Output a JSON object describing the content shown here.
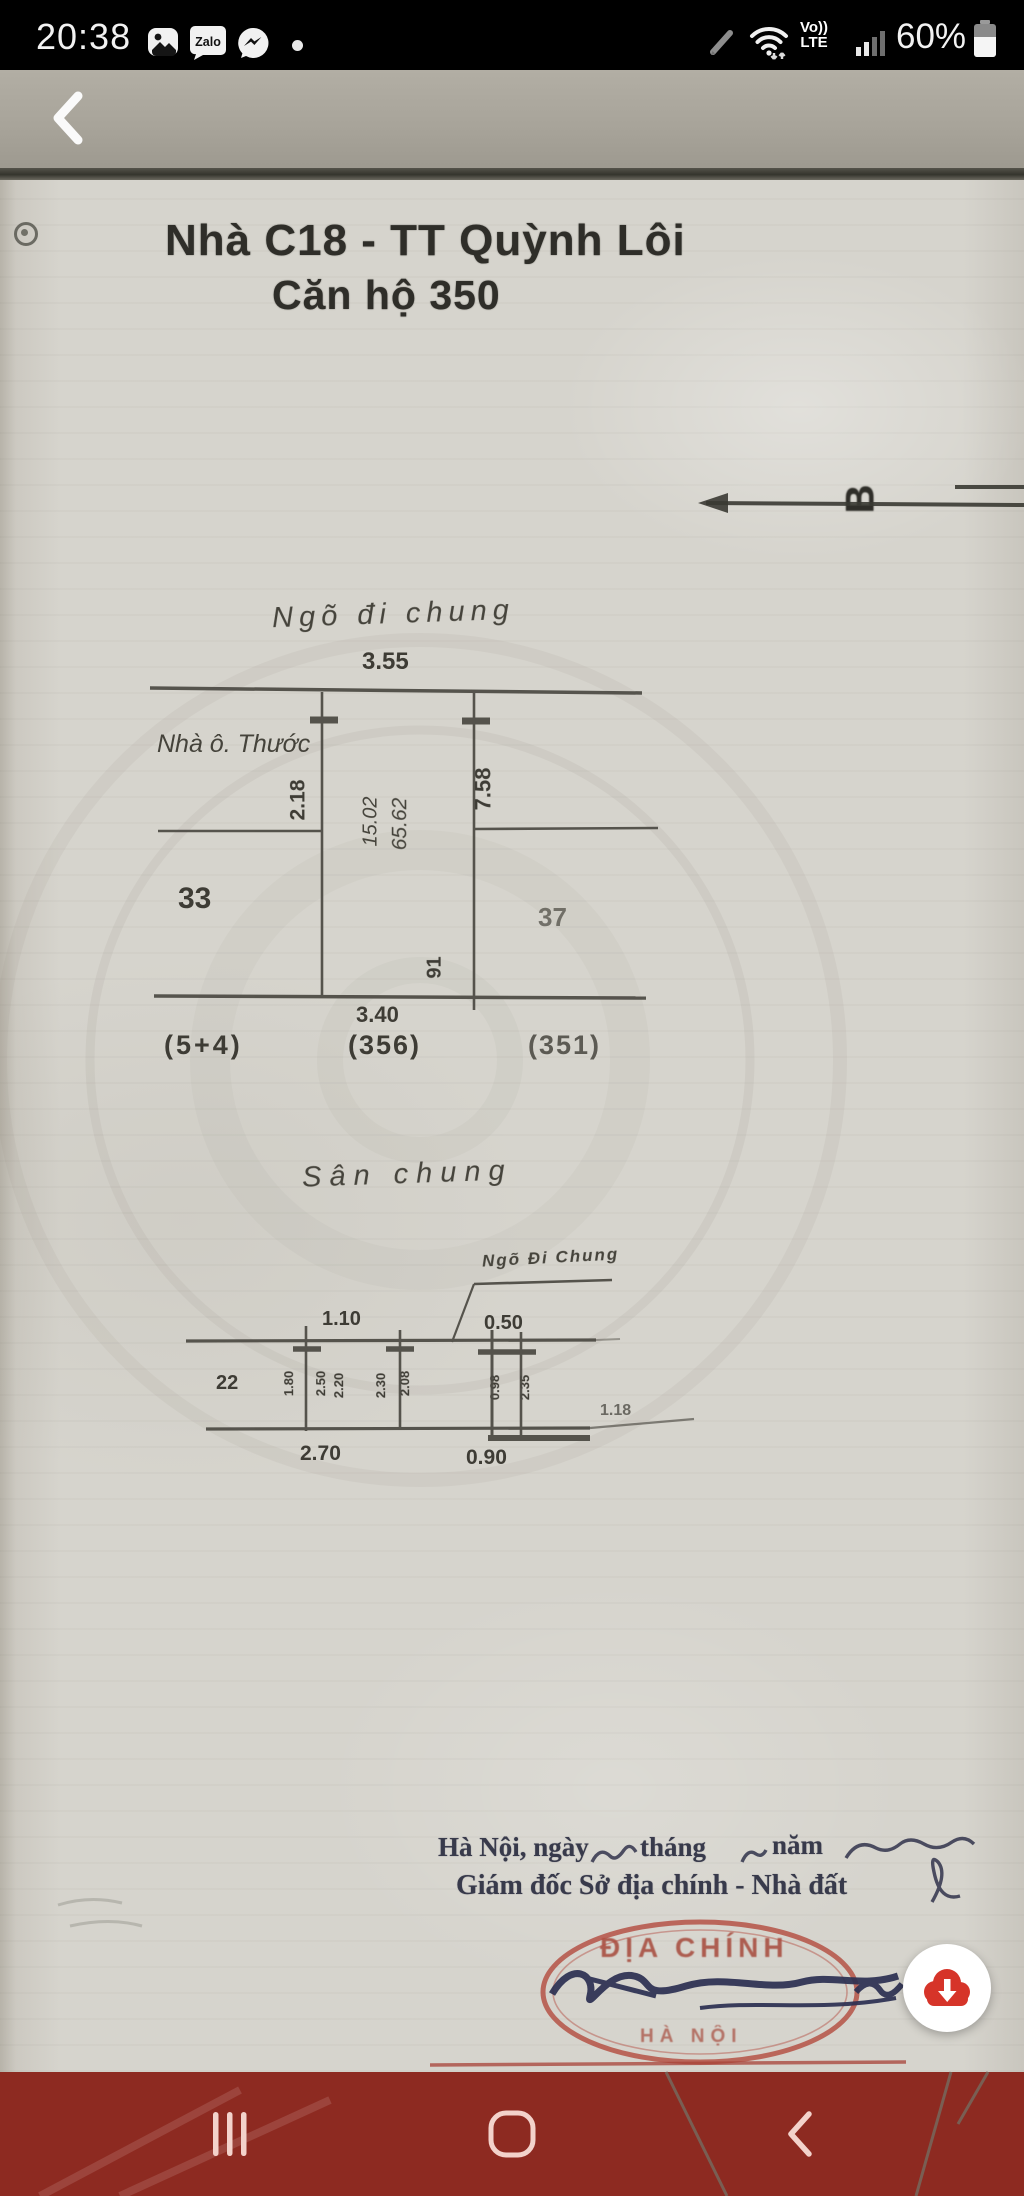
{
  "status_bar": {
    "time": "20:38",
    "battery_percent": "60%",
    "volte_line1": "Vo))",
    "volte_line2": "LTE",
    "zalo_label": "Zalo"
  },
  "document": {
    "title_line1": "Nhà C18 - TT Quỳnh Lôi",
    "title_line2": "Căn hộ 350",
    "compass_label": "B",
    "plan": {
      "street_label": "Ngõ đi chung",
      "top_width": "3.55",
      "neighbor_label": "Nhà ô. Thước",
      "left_depth": "2.18",
      "area_value_1": "15.02",
      "area_value_2": "65.62",
      "right_depth": "7.58",
      "left_plot": "33",
      "right_plot": "37",
      "corner_mark": "91",
      "bottom_width": "3.40",
      "ref_left": "(5+4)",
      "ref_center": "(356)",
      "ref_right": "(351)"
    },
    "section": {
      "yard_label": "Sân chung",
      "alley_label": "Ngõ Đi Chung",
      "dim_a": "1.10",
      "dim_b": "0.50",
      "left_mark": "22",
      "small_dims": [
        "1.80",
        "2.50",
        "2.20",
        "2.30",
        "2.08",
        "0.98",
        "2.35"
      ],
      "dim_right": "1.18",
      "bottom_dim_left": "2.70",
      "bottom_dim_right": "0.90"
    },
    "footer": {
      "date_part1": "Hà Nội, ngày",
      "date_part2": "tháng",
      "date_part3": "năm",
      "signer_title": "Giám đốc Sở địa chính - Nhà đất"
    },
    "stamp": {
      "arc_text": "ĐỊA CHÍNH",
      "bottom_text": "HÀ NỘI"
    }
  },
  "colors": {
    "nav_bar": "#8d2a21",
    "fab_red": "#d63429",
    "stamp_red": "#a6493b",
    "signature_blue": "#2c3052",
    "paper": "#d6d4cd"
  }
}
